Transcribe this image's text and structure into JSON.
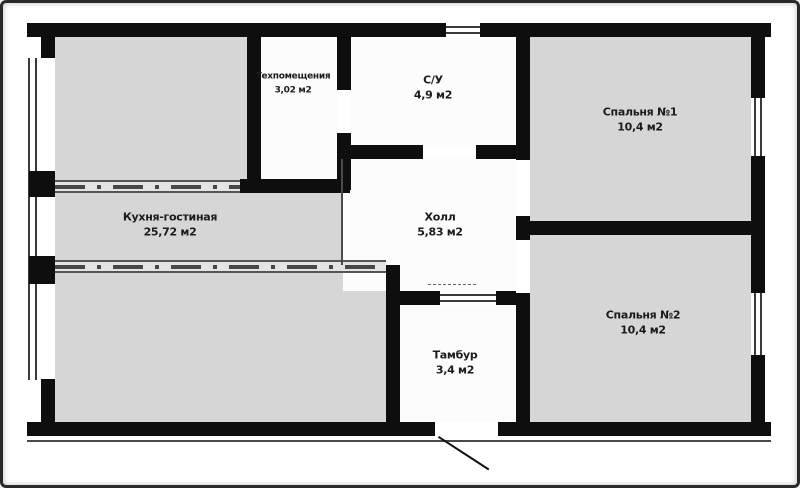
{
  "plan": {
    "type": "apartment-floor-plan",
    "rooms": [
      {
        "id": "tech",
        "name": "Техпомещения",
        "area": "3,02 м2"
      },
      {
        "id": "bathroom",
        "name": "С/У",
        "area": "4,9 м2"
      },
      {
        "id": "bedroom1",
        "name": "Спальня №1",
        "area": "10,4 м2"
      },
      {
        "id": "kitchen",
        "name": "Кухня-гостиная",
        "area": "25,72 м2"
      },
      {
        "id": "hall",
        "name": "Холл",
        "area": "5,83 м2"
      },
      {
        "id": "bedroom2",
        "name": "Спальня №2",
        "area": "10,4 м2"
      },
      {
        "id": "tambour",
        "name": "Тамбур",
        "area": "3,4 м2"
      }
    ],
    "colors": {
      "wall": "#0e0e0e",
      "room_gray": "#d6d6d6",
      "room_white": "#fcfcfc",
      "band_dash": "#474747",
      "photo_frame": "#2a2a2a"
    }
  }
}
